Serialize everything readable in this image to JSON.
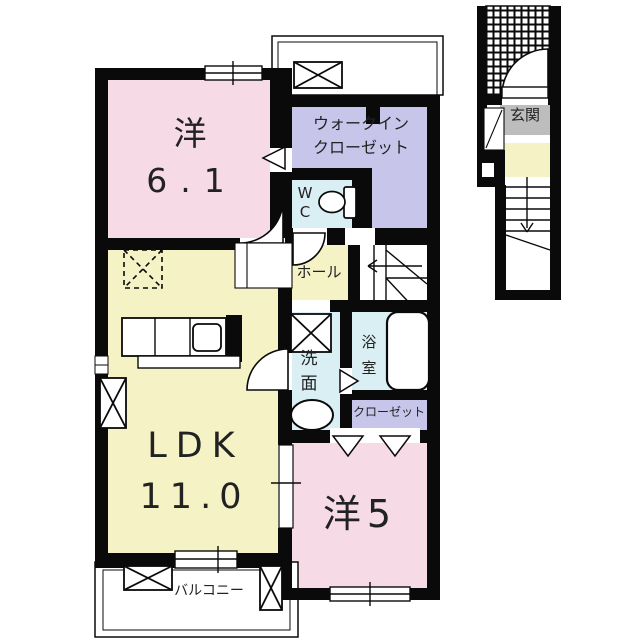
{
  "floorplan": {
    "unit": {
      "western_6_1": {
        "label": "洋",
        "size": "6.1"
      },
      "walk_in_closet": {
        "line1": "ウォークイン",
        "line2": "クローゼット"
      },
      "wc": {
        "label": "W\nC"
      },
      "hall": {
        "label": "ホール"
      },
      "washroom": {
        "label": "洗\n面"
      },
      "bathroom": {
        "label": "浴\n室"
      },
      "closet": {
        "label": "クローゼット"
      },
      "ldk": {
        "label": "LDK",
        "size": "11.0"
      },
      "western_5": {
        "label": "洋5"
      },
      "balcony": {
        "label": "バルコニー"
      },
      "entrance": {
        "label": "玄関"
      }
    },
    "colors": {
      "room_pink": "#F6DBE6",
      "room_yellow": "#F5F2C6",
      "room_lavender": "#C8C5EB",
      "room_cyan": "#D9EFF3",
      "entrance_gray": "#BDBDBD",
      "wall_black": "#0A0A0A"
    }
  }
}
